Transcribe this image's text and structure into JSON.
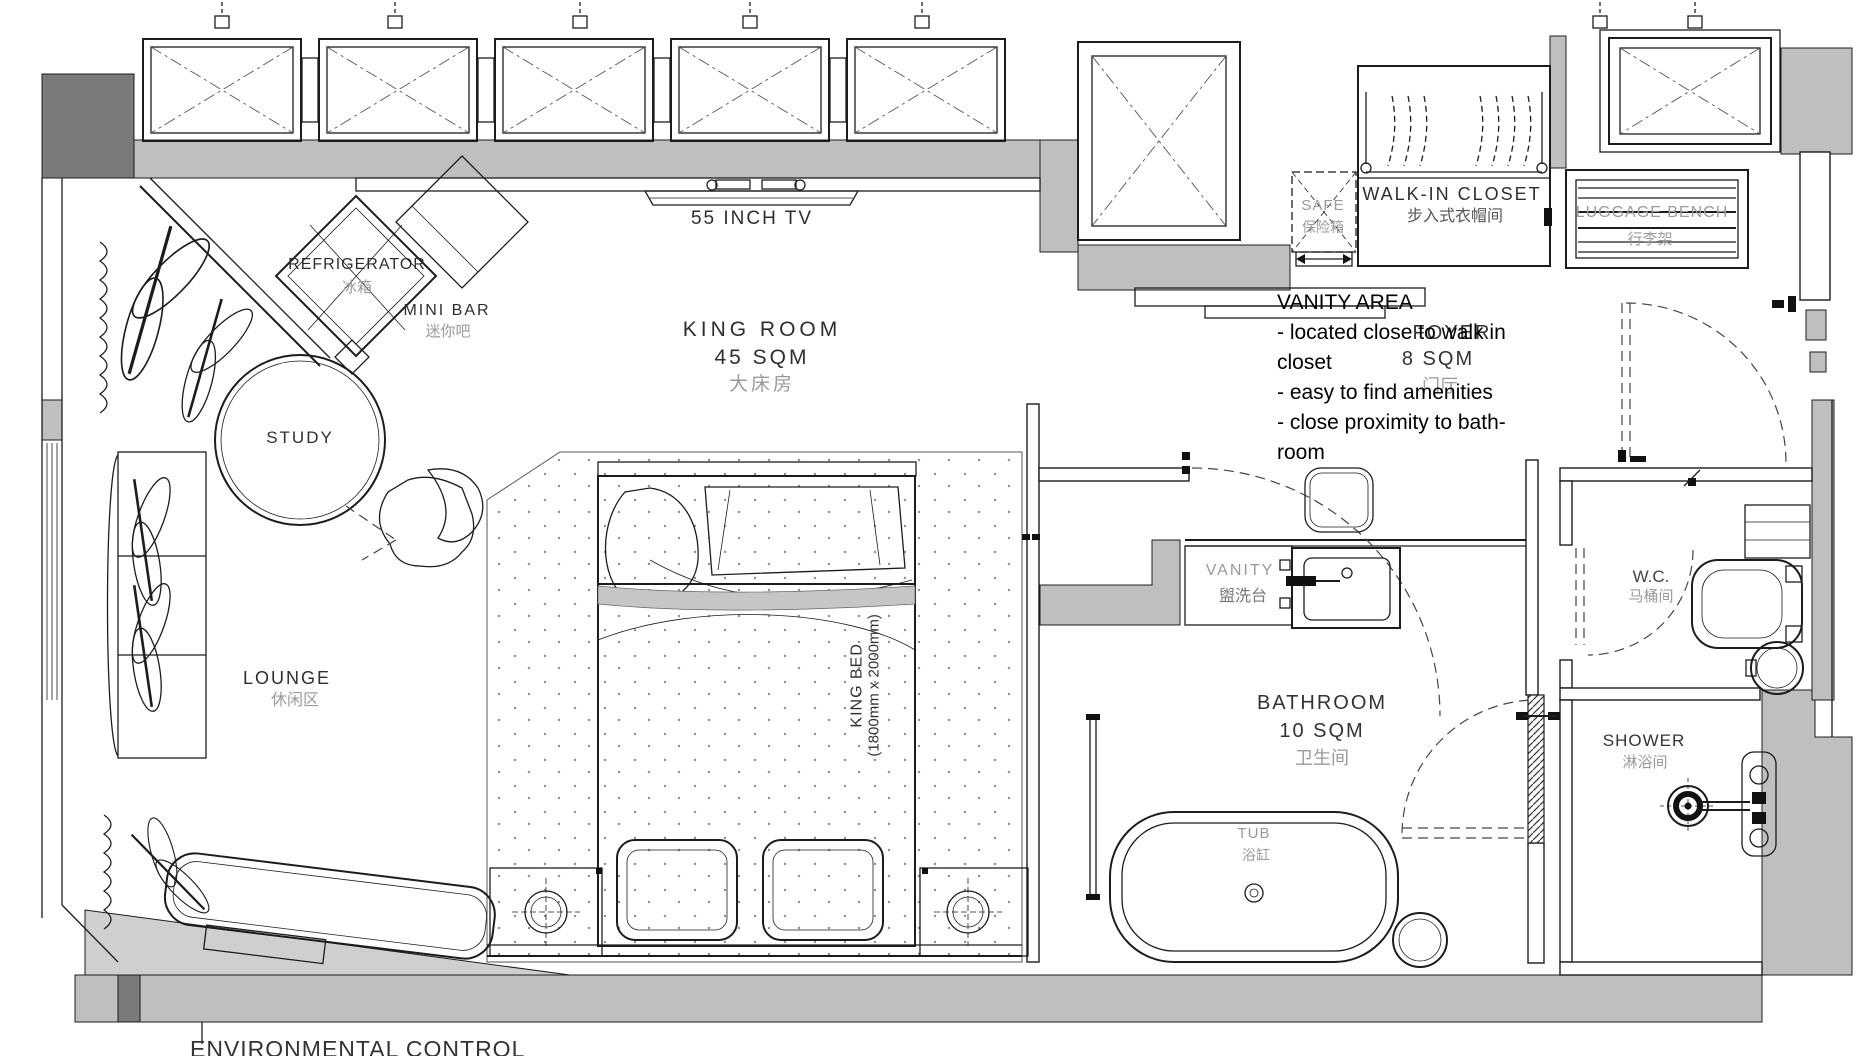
{
  "plan": {
    "rooms": {
      "king_room": {
        "label": "KING ROOM",
        "area": "45 SQM",
        "label_cn": "大床房"
      },
      "foyer": {
        "label": "FOYER",
        "area": "8 SQM",
        "label_cn": "门厅"
      },
      "bathroom": {
        "label": "BATHROOM",
        "area": "10 SQM",
        "label_cn": "卫生间"
      },
      "walk_in_closet": {
        "label": "WALK-IN CLOSET",
        "label_cn": "步入式衣帽间"
      },
      "wc": {
        "label": "W.C.",
        "label_cn": "马桶间"
      },
      "shower": {
        "label": "SHOWER",
        "label_cn": "淋浴间"
      },
      "lounge": {
        "label": "LOUNGE",
        "label_cn": "休闲区"
      }
    },
    "fixtures": {
      "tv": {
        "label": "55 INCH TV"
      },
      "refrigerator": {
        "label": "REFRIGERATOR",
        "label_cn": "冰箱"
      },
      "mini_bar": {
        "label": "MINI BAR",
        "label_cn": "迷你吧"
      },
      "study": {
        "label": "STUDY"
      },
      "safe": {
        "label": "SAFE",
        "label_cn": "保险箱"
      },
      "luggage_bench": {
        "label": "LUGGAGE BENCH",
        "label_cn": "行李架"
      },
      "vanity": {
        "label": "VANITY",
        "label_cn": "盥洗台"
      },
      "tub": {
        "label": "TUB",
        "label_cn": "浴缸"
      },
      "king_bed": {
        "label": "KING BED",
        "dimensions": "(1800mm x 2000mm)"
      }
    },
    "annotations": {
      "vanity_area": {
        "title": "VANITY AREA",
        "lines": [
          "- located close to walk in",
          "closet",
          "- easy to find amenities",
          "- close proximity to bath-",
          "room"
        ]
      },
      "environmental_control": {
        "label": "ENVIRONMENTAL CONTROL"
      }
    },
    "colors": {
      "wall_gray": "#bfbfbf",
      "wall_dark": "#7a7a7a",
      "line": "#1c1c1c",
      "muted_text": "#9a9a9a"
    }
  }
}
